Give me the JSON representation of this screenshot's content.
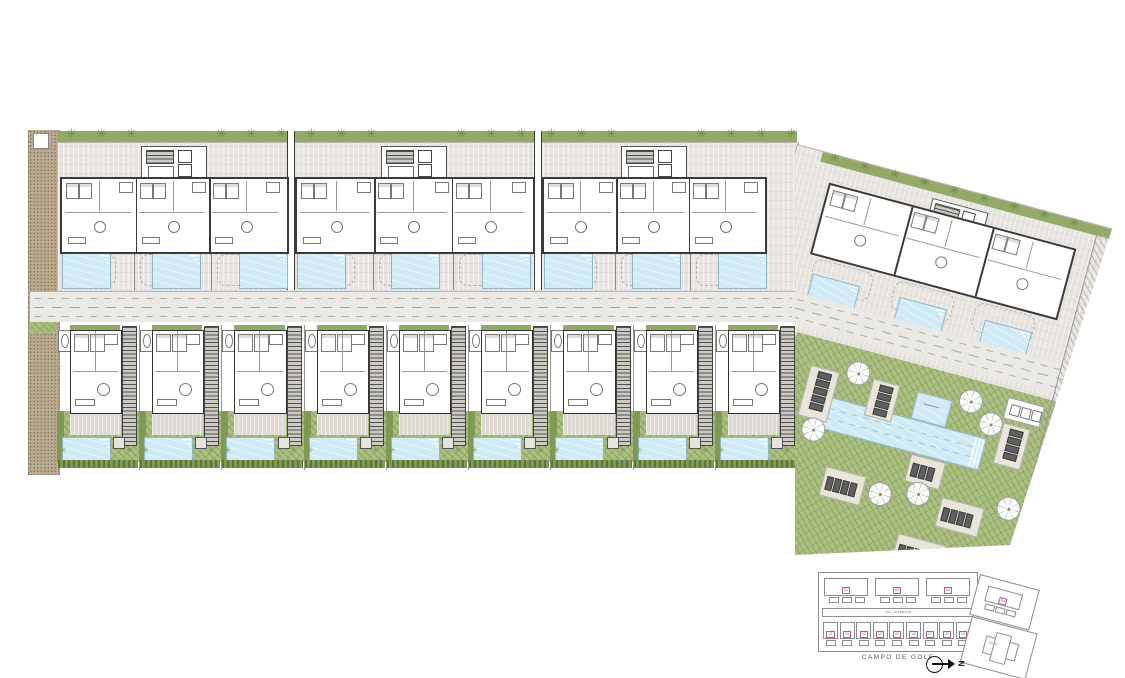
{
  "drawing": {
    "golf_label": "CAMPO DE GOLF",
    "road_label": "VIAL INTERIOR",
    "services_label": "SS.CC",
    "north_label": "N"
  },
  "key_plan": {
    "block_labels": [
      "B1",
      "B2",
      "B3"
    ],
    "right_block_label": "B4",
    "villa_labels": [
      "V1",
      "V2",
      "V3",
      "V4",
      "V5",
      "V6",
      "V7",
      "V8",
      "V9"
    ]
  },
  "site": {
    "apartment_blocks": 3,
    "units_per_apartment_block": 3,
    "pools_top_row": 9,
    "villas": 9,
    "pools_per_villa": 1,
    "rotated_block_units": 3,
    "communal_pools": 2,
    "parasols": 7,
    "lounger_pads": 7,
    "hedge_trees_top": 24,
    "hedge_trees_right": 9
  },
  "colors": {
    "paving": "#e7e3de",
    "wall": "#3a3a3a",
    "inner_wall": "#999999",
    "hedge": "#93a968",
    "hedge_dark": "#7e9a55",
    "tree": "#6f8a4a",
    "lawn": "#abbf81",
    "water": "#cfe9f5",
    "water_edge": "#8fb7c9",
    "road": "#ebe9e6",
    "road_dash": "#b1aea9",
    "path": "#b9aa90",
    "stair": "#50504e",
    "lounger": "#5f5f5f",
    "pad": "#e9e5db",
    "label_pink": "#b5559a",
    "outline": "#8c8c8c"
  }
}
